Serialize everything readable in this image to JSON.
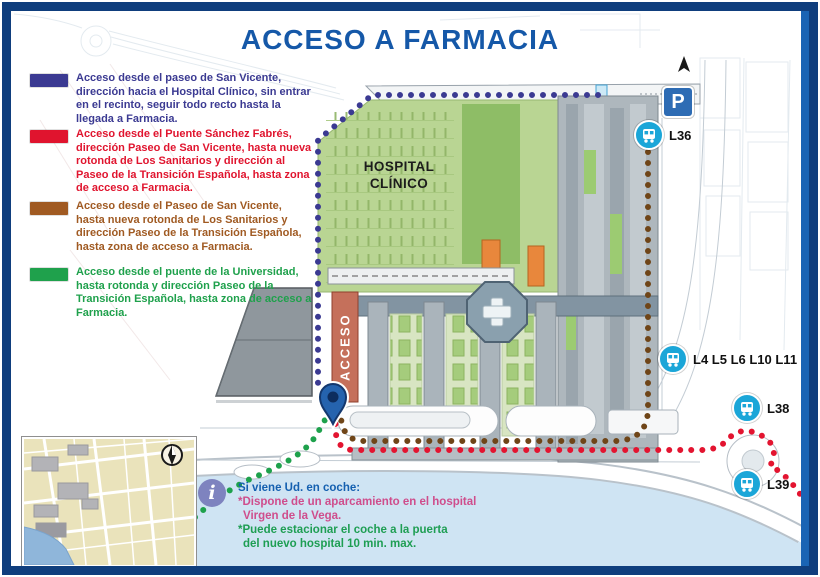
{
  "title": "ACCESO A FARMACIA",
  "legend": {
    "items": [
      {
        "color": "#3b3a92",
        "text": "Acceso desde el paseo de San Vicente, dirección hacia el Hospital Clínico, sin entrar en el recinto, seguir todo recto hasta la llegada a Farmacia."
      },
      {
        "color": "#e0142e",
        "text": "Acceso desde el Puente Sánchez Fabrés, dirección Paseo de San Vicente, hasta nueva rotonda de Los Sanitarios y dirección al Paseo de la Transición Española, hasta zona de acceso a Farmacia."
      },
      {
        "color": "#a05a22",
        "text": "Acceso desde el Paseo de San Vicente, hasta nueva rotonda de Los Sanitarios y dirección Paseo de la Transición Española, hasta zona de acceso a Farmacia."
      },
      {
        "color": "#1fa14c",
        "text": "Acceso desde el puente de la Universidad, hasta rotonda y dirección Paseo de la Transición Española, hasta zona de acceso a Farmacia."
      }
    ]
  },
  "map": {
    "hospital_label_line1": "HOSPITAL",
    "hospital_label_line2": "CLÍNICO",
    "acceso_label": "ACCESO",
    "parking_label": "P",
    "bus_stops": [
      {
        "label": "L36"
      },
      {
        "label": "L4 L5 L6 L10 L11"
      },
      {
        "label": "L38"
      },
      {
        "label": "L39"
      }
    ]
  },
  "info_box": {
    "icon": "i",
    "line1": "Si viene Ud. en coche:",
    "line2": "*Dispone de un aparcamiento en el hospital",
    "line3": "Virgen de la Vega.",
    "line4": "*Puede estacionar el coche a la puerta",
    "line5": "del nuevo hospital 10 min. max."
  },
  "colors": {
    "title": "#1558a8",
    "frame": "#0f3e7d",
    "bus": "#1ba6d8",
    "parking": "#2e6cb4",
    "river": "#cfe4f3",
    "hospital_green": "#b9d593",
    "acceso_strip": "#c5705b",
    "routes": {
      "blue": "#3b3a92",
      "red": "#e31430",
      "brown": "#6f4518",
      "green": "#1ea14c"
    }
  }
}
